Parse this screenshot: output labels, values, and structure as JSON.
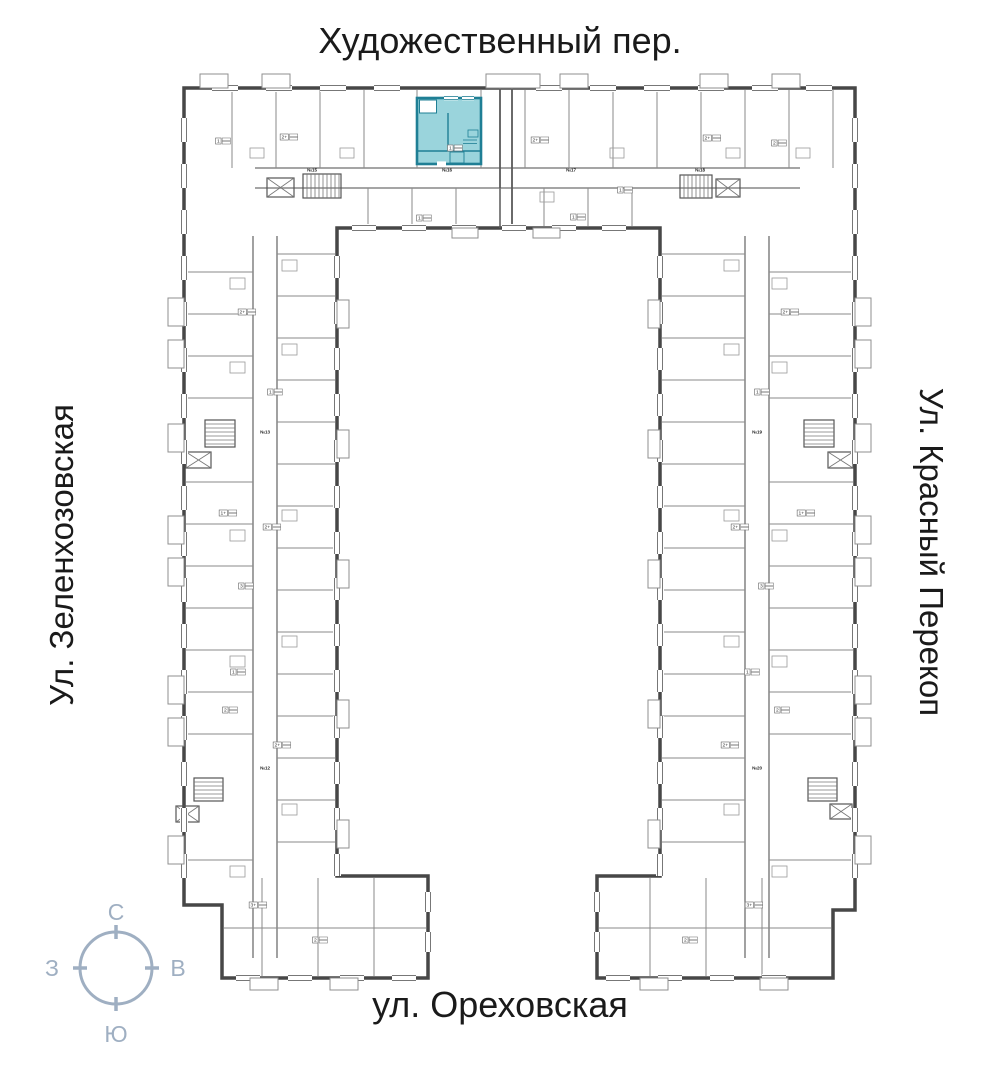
{
  "streets": {
    "top": "Художественный пер.",
    "left": "Ул. Зеленхозовская",
    "right": "Ул. Красный Перекоп",
    "bottom": "ул. Ореховская"
  },
  "compass": {
    "north": "С",
    "south": "Ю",
    "west": "З",
    "east": "В"
  },
  "colors": {
    "highlight_fill": "#9AD4DC",
    "highlight_wall": "#1F7F95",
    "compass": "#9FAFC2",
    "wall": "#474747",
    "text": "#1a1a1a"
  },
  "highlighted_apartment": {
    "rooms_label": "1"
  },
  "plan": {
    "apartment_type_labels": [
      {
        "t": "1",
        "x": 223,
        "y": 141
      },
      {
        "t": "2+",
        "x": 289,
        "y": 137
      },
      {
        "t": "1",
        "x": 455,
        "y": 148
      },
      {
        "t": "2+",
        "x": 540,
        "y": 140
      },
      {
        "t": "2+",
        "x": 712,
        "y": 138
      },
      {
        "t": "2",
        "x": 779,
        "y": 143
      },
      {
        "t": "1",
        "x": 424,
        "y": 218
      },
      {
        "t": "1",
        "x": 578,
        "y": 217
      },
      {
        "t": "1",
        "x": 625,
        "y": 190
      },
      {
        "t": "2+",
        "x": 247,
        "y": 312
      },
      {
        "t": "1",
        "x": 275,
        "y": 392
      },
      {
        "t": "1+",
        "x": 228,
        "y": 513
      },
      {
        "t": "2+",
        "x": 272,
        "y": 527
      },
      {
        "t": "3",
        "x": 246,
        "y": 586
      },
      {
        "t": "1",
        "x": 238,
        "y": 672
      },
      {
        "t": "2",
        "x": 230,
        "y": 710
      },
      {
        "t": "2+",
        "x": 282,
        "y": 745
      },
      {
        "t": "3+",
        "x": 258,
        "y": 905
      },
      {
        "t": "2",
        "x": 320,
        "y": 940
      },
      {
        "t": "2+",
        "x": 790,
        "y": 312
      },
      {
        "t": "1",
        "x": 762,
        "y": 392
      },
      {
        "t": "1+",
        "x": 806,
        "y": 513
      },
      {
        "t": "2+",
        "x": 740,
        "y": 527
      },
      {
        "t": "3",
        "x": 766,
        "y": 586
      },
      {
        "t": "1",
        "x": 752,
        "y": 672
      },
      {
        "t": "2",
        "x": 782,
        "y": 710
      },
      {
        "t": "2+",
        "x": 730,
        "y": 745
      },
      {
        "t": "3+",
        "x": 754,
        "y": 905
      },
      {
        "t": "2",
        "x": 690,
        "y": 940
      }
    ],
    "unit_tags": [
      {
        "t": "№15",
        "x": 312,
        "y": 170
      },
      {
        "t": "№16",
        "x": 447,
        "y": 170
      },
      {
        "t": "№17",
        "x": 571,
        "y": 170
      },
      {
        "t": "№18",
        "x": 700,
        "y": 170
      },
      {
        "t": "№13",
        "x": 265,
        "y": 432
      },
      {
        "t": "№12",
        "x": 265,
        "y": 768
      },
      {
        "t": "№19",
        "x": 757,
        "y": 432
      },
      {
        "t": "№20",
        "x": 757,
        "y": 768
      }
    ]
  }
}
